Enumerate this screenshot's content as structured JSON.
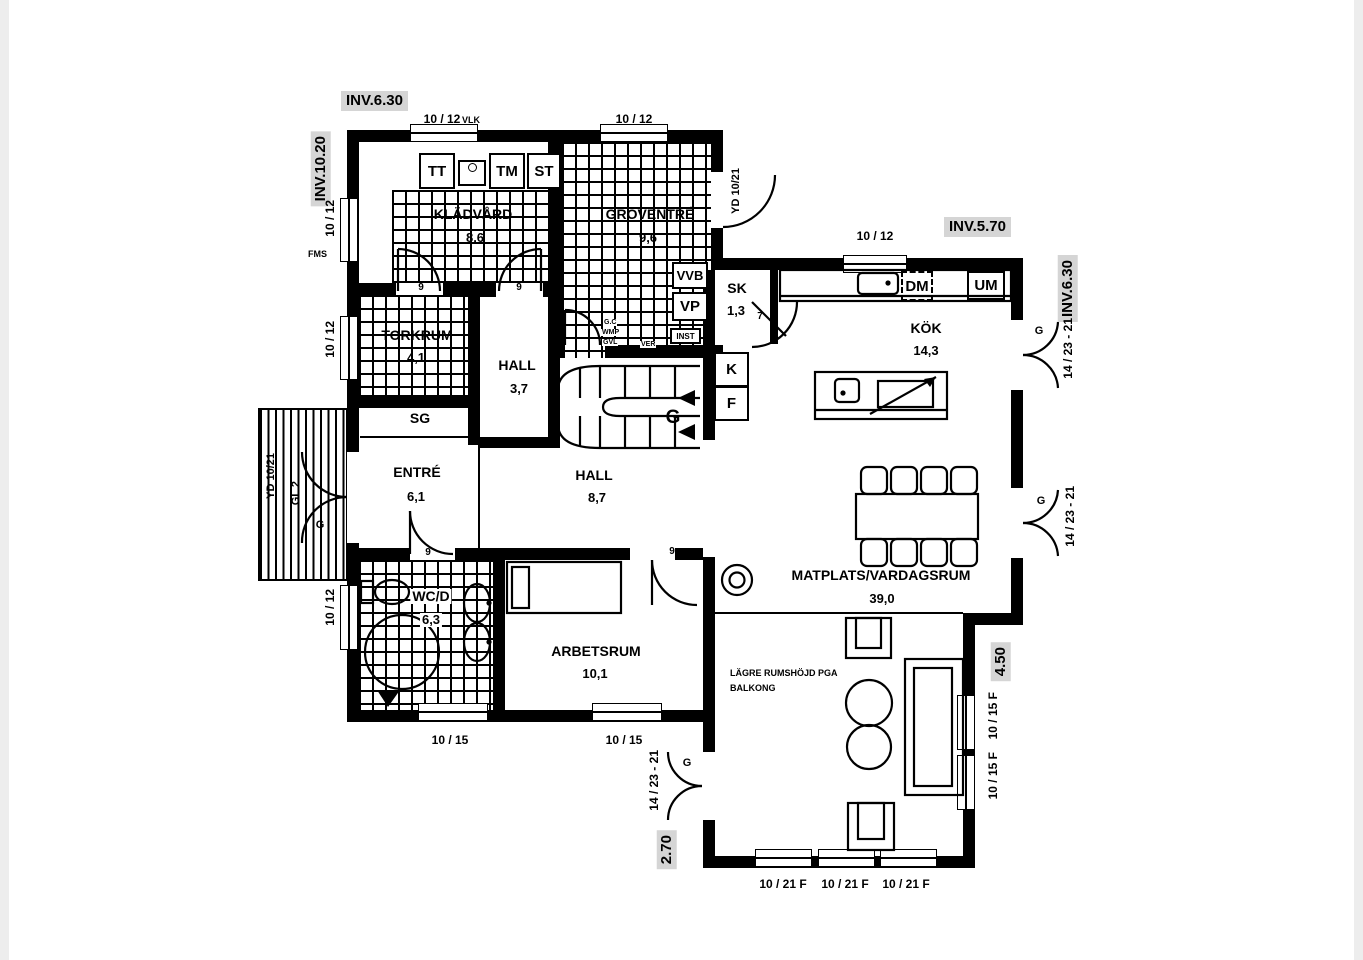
{
  "inv_labels": {
    "top_left": "INV.6.30",
    "left_wall": "INV.10.20",
    "kitchen_top": "INV.5.70",
    "kitchen_right": "INV.6.30",
    "living_right": "4.50",
    "balcony_left": "2.70"
  },
  "rooms": {
    "kladvard": {
      "name": "KLÄDVÅRD",
      "area": "8,6"
    },
    "groventre": {
      "name": "GROVENTRÉ",
      "area": "9,6"
    },
    "torkrum": {
      "name": "TORKRUM",
      "area": "4,1"
    },
    "hall_ovre": {
      "name": "HALL",
      "area": "3,7"
    },
    "sg": {
      "name": "SG"
    },
    "entre": {
      "name": "ENTRÉ",
      "area": "6,1"
    },
    "hall": {
      "name": "HALL",
      "area": "8,7"
    },
    "wcd": {
      "name": "WC/D",
      "area": "6,3"
    },
    "arbetsrum": {
      "name": "ARBETSRUM",
      "area": "10,1"
    },
    "sk": {
      "name": "SK",
      "area": "1,3"
    },
    "kok": {
      "name": "KÖK",
      "area": "14,3"
    },
    "matplats": {
      "name": "MATPLATS/VARDAGSRUM",
      "area": "39,0"
    }
  },
  "appliances": {
    "tt": "TT",
    "tm": "TM",
    "st": "ST",
    "vvb": "VVB",
    "vp": "VP",
    "inst": "INST",
    "dm": "DM",
    "um": "UM",
    "kyl": "K",
    "frys": "F"
  },
  "dims": {
    "w1012": "10 / 12",
    "w1015": "10 / 15",
    "w1015f": "10 / 15 F",
    "w1021f": "10 / 21 F",
    "d1423": "14 / 23 - 21",
    "d9": "9",
    "d7": "7"
  },
  "notes": {
    "vlk": "VLK",
    "fms": "FMS",
    "yd": "YD 10/21",
    "gl2": "GL 2",
    "g": "G",
    "gc": "G.C",
    "wmp": "WMP",
    "gvl": "GVL",
    "ver": "VER",
    "lagre1": "LÄGRE RUMSHÖJD PGA",
    "lagre2": "BALKONG"
  }
}
